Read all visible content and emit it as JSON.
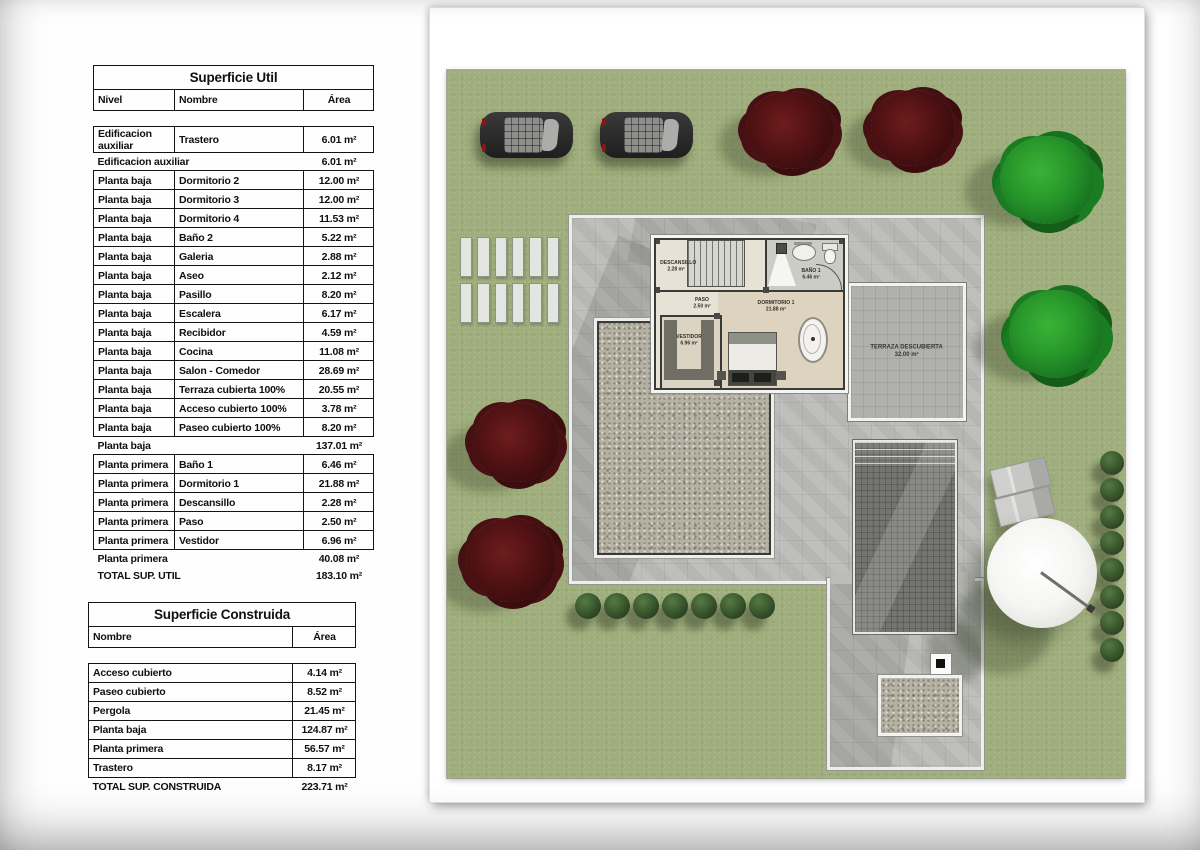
{
  "tables": {
    "util": {
      "title": "Superficie Util",
      "columns": [
        "Nivel",
        "Nombre",
        "Área"
      ],
      "rows": [
        {
          "type": "spacer",
          "cells": [
            "",
            "",
            ""
          ]
        },
        {
          "type": "data",
          "cells": [
            "Edificacion auxiliar",
            "Trastero",
            "6.01 m²"
          ]
        },
        {
          "type": "subtotal",
          "cells": [
            "Edificacion auxiliar",
            "",
            "6.01 m²"
          ]
        },
        {
          "type": "data",
          "cells": [
            "Planta baja",
            "Dormitorio 2",
            "12.00 m²"
          ]
        },
        {
          "type": "data",
          "cells": [
            "Planta baja",
            "Dormitorio 3",
            "12.00 m²"
          ]
        },
        {
          "type": "data",
          "cells": [
            "Planta baja",
            "Dormitorio 4",
            "11.53 m²"
          ]
        },
        {
          "type": "data",
          "cells": [
            "Planta baja",
            "Baño 2",
            "5.22 m²"
          ]
        },
        {
          "type": "data",
          "cells": [
            "Planta baja",
            "Galeria",
            "2.88 m²"
          ]
        },
        {
          "type": "data",
          "cells": [
            "Planta baja",
            "Aseo",
            "2.12 m²"
          ]
        },
        {
          "type": "data",
          "cells": [
            "Planta baja",
            "Pasillo",
            "8.20 m²"
          ]
        },
        {
          "type": "data",
          "cells": [
            "Planta baja",
            "Escalera",
            "6.17 m²"
          ]
        },
        {
          "type": "data",
          "cells": [
            "Planta baja",
            "Recibidor",
            "4.59 m²"
          ]
        },
        {
          "type": "data",
          "cells": [
            "Planta baja",
            "Cocina",
            "11.08 m²"
          ]
        },
        {
          "type": "data",
          "cells": [
            "Planta baja",
            "Salon - Comedor",
            "28.69 m²"
          ]
        },
        {
          "type": "data",
          "cells": [
            "Planta baja",
            "Terraza cubierta 100%",
            "20.55 m²"
          ]
        },
        {
          "type": "data",
          "cells": [
            "Planta baja",
            "Acceso cubierto 100%",
            "3.78 m²"
          ]
        },
        {
          "type": "data",
          "cells": [
            "Planta baja",
            "Paseo cubierto 100%",
            "8.20 m²"
          ]
        },
        {
          "type": "subtotal",
          "cells": [
            "Planta baja",
            "",
            "137.01 m²"
          ]
        },
        {
          "type": "data",
          "cells": [
            "Planta primera",
            "Baño 1",
            "6.46 m²"
          ]
        },
        {
          "type": "data",
          "cells": [
            "Planta primera",
            "Dormitorio 1",
            "21.88 m²"
          ]
        },
        {
          "type": "data",
          "cells": [
            "Planta primera",
            "Descansillo",
            "2.28 m²"
          ]
        },
        {
          "type": "data",
          "cells": [
            "Planta primera",
            "Paso",
            "2.50 m²"
          ]
        },
        {
          "type": "data",
          "cells": [
            "Planta primera",
            "Vestidor",
            "6.96 m²"
          ]
        },
        {
          "type": "subtotal",
          "cells": [
            "Planta primera",
            "",
            "40.08 m²"
          ]
        },
        {
          "type": "total",
          "cells": [
            "TOTAL SUP. UTIL",
            "",
            "183.10 m²"
          ]
        }
      ]
    },
    "construida": {
      "title": "Superficie Construida",
      "columns": [
        "Nombre",
        "Área"
      ],
      "rows": [
        {
          "type": "spacer",
          "cells": [
            "",
            ""
          ]
        },
        {
          "type": "data",
          "cells": [
            "Acceso cubierto",
            "4.14 m²"
          ]
        },
        {
          "type": "data",
          "cells": [
            "Paseo cubierto",
            "8.52 m²"
          ]
        },
        {
          "type": "data",
          "cells": [
            "Pergola",
            "21.45 m²"
          ]
        },
        {
          "type": "data",
          "cells": [
            "Planta baja",
            "124.87 m²"
          ]
        },
        {
          "type": "data",
          "cells": [
            "Planta primera",
            "56.57 m²"
          ]
        },
        {
          "type": "data",
          "cells": [
            "Trastero",
            "8.17 m²"
          ]
        },
        {
          "type": "total",
          "cells": [
            "TOTAL SUP. CONSTRUIDA",
            "223.71 m²"
          ]
        }
      ]
    }
  },
  "plan": {
    "labels": {
      "descansillo": {
        "name": "DESCANSILLO",
        "area": "2.28 m²"
      },
      "paso": {
        "name": "PASO",
        "area": "2.50 m²"
      },
      "bano1": {
        "name": "BAÑO 1",
        "area": "6.46 m²"
      },
      "dormitorio1": {
        "name": "DORMITORIO 1",
        "area": "21.88 m²"
      },
      "vestidor": {
        "name": "VESTIDOR",
        "area": "6.96 m²"
      },
      "terraza": {
        "name": "TERRAZA DESCUBIERTA",
        "area": "32.00 m²"
      }
    },
    "colors": {
      "grass": "#9fae7c",
      "paving": "#bcbcba",
      "gravel": "#b5b1a3",
      "pool": "#747472",
      "tree_red": "#531214",
      "tree_green": "#27962a",
      "bush": "#3c5a30"
    }
  }
}
